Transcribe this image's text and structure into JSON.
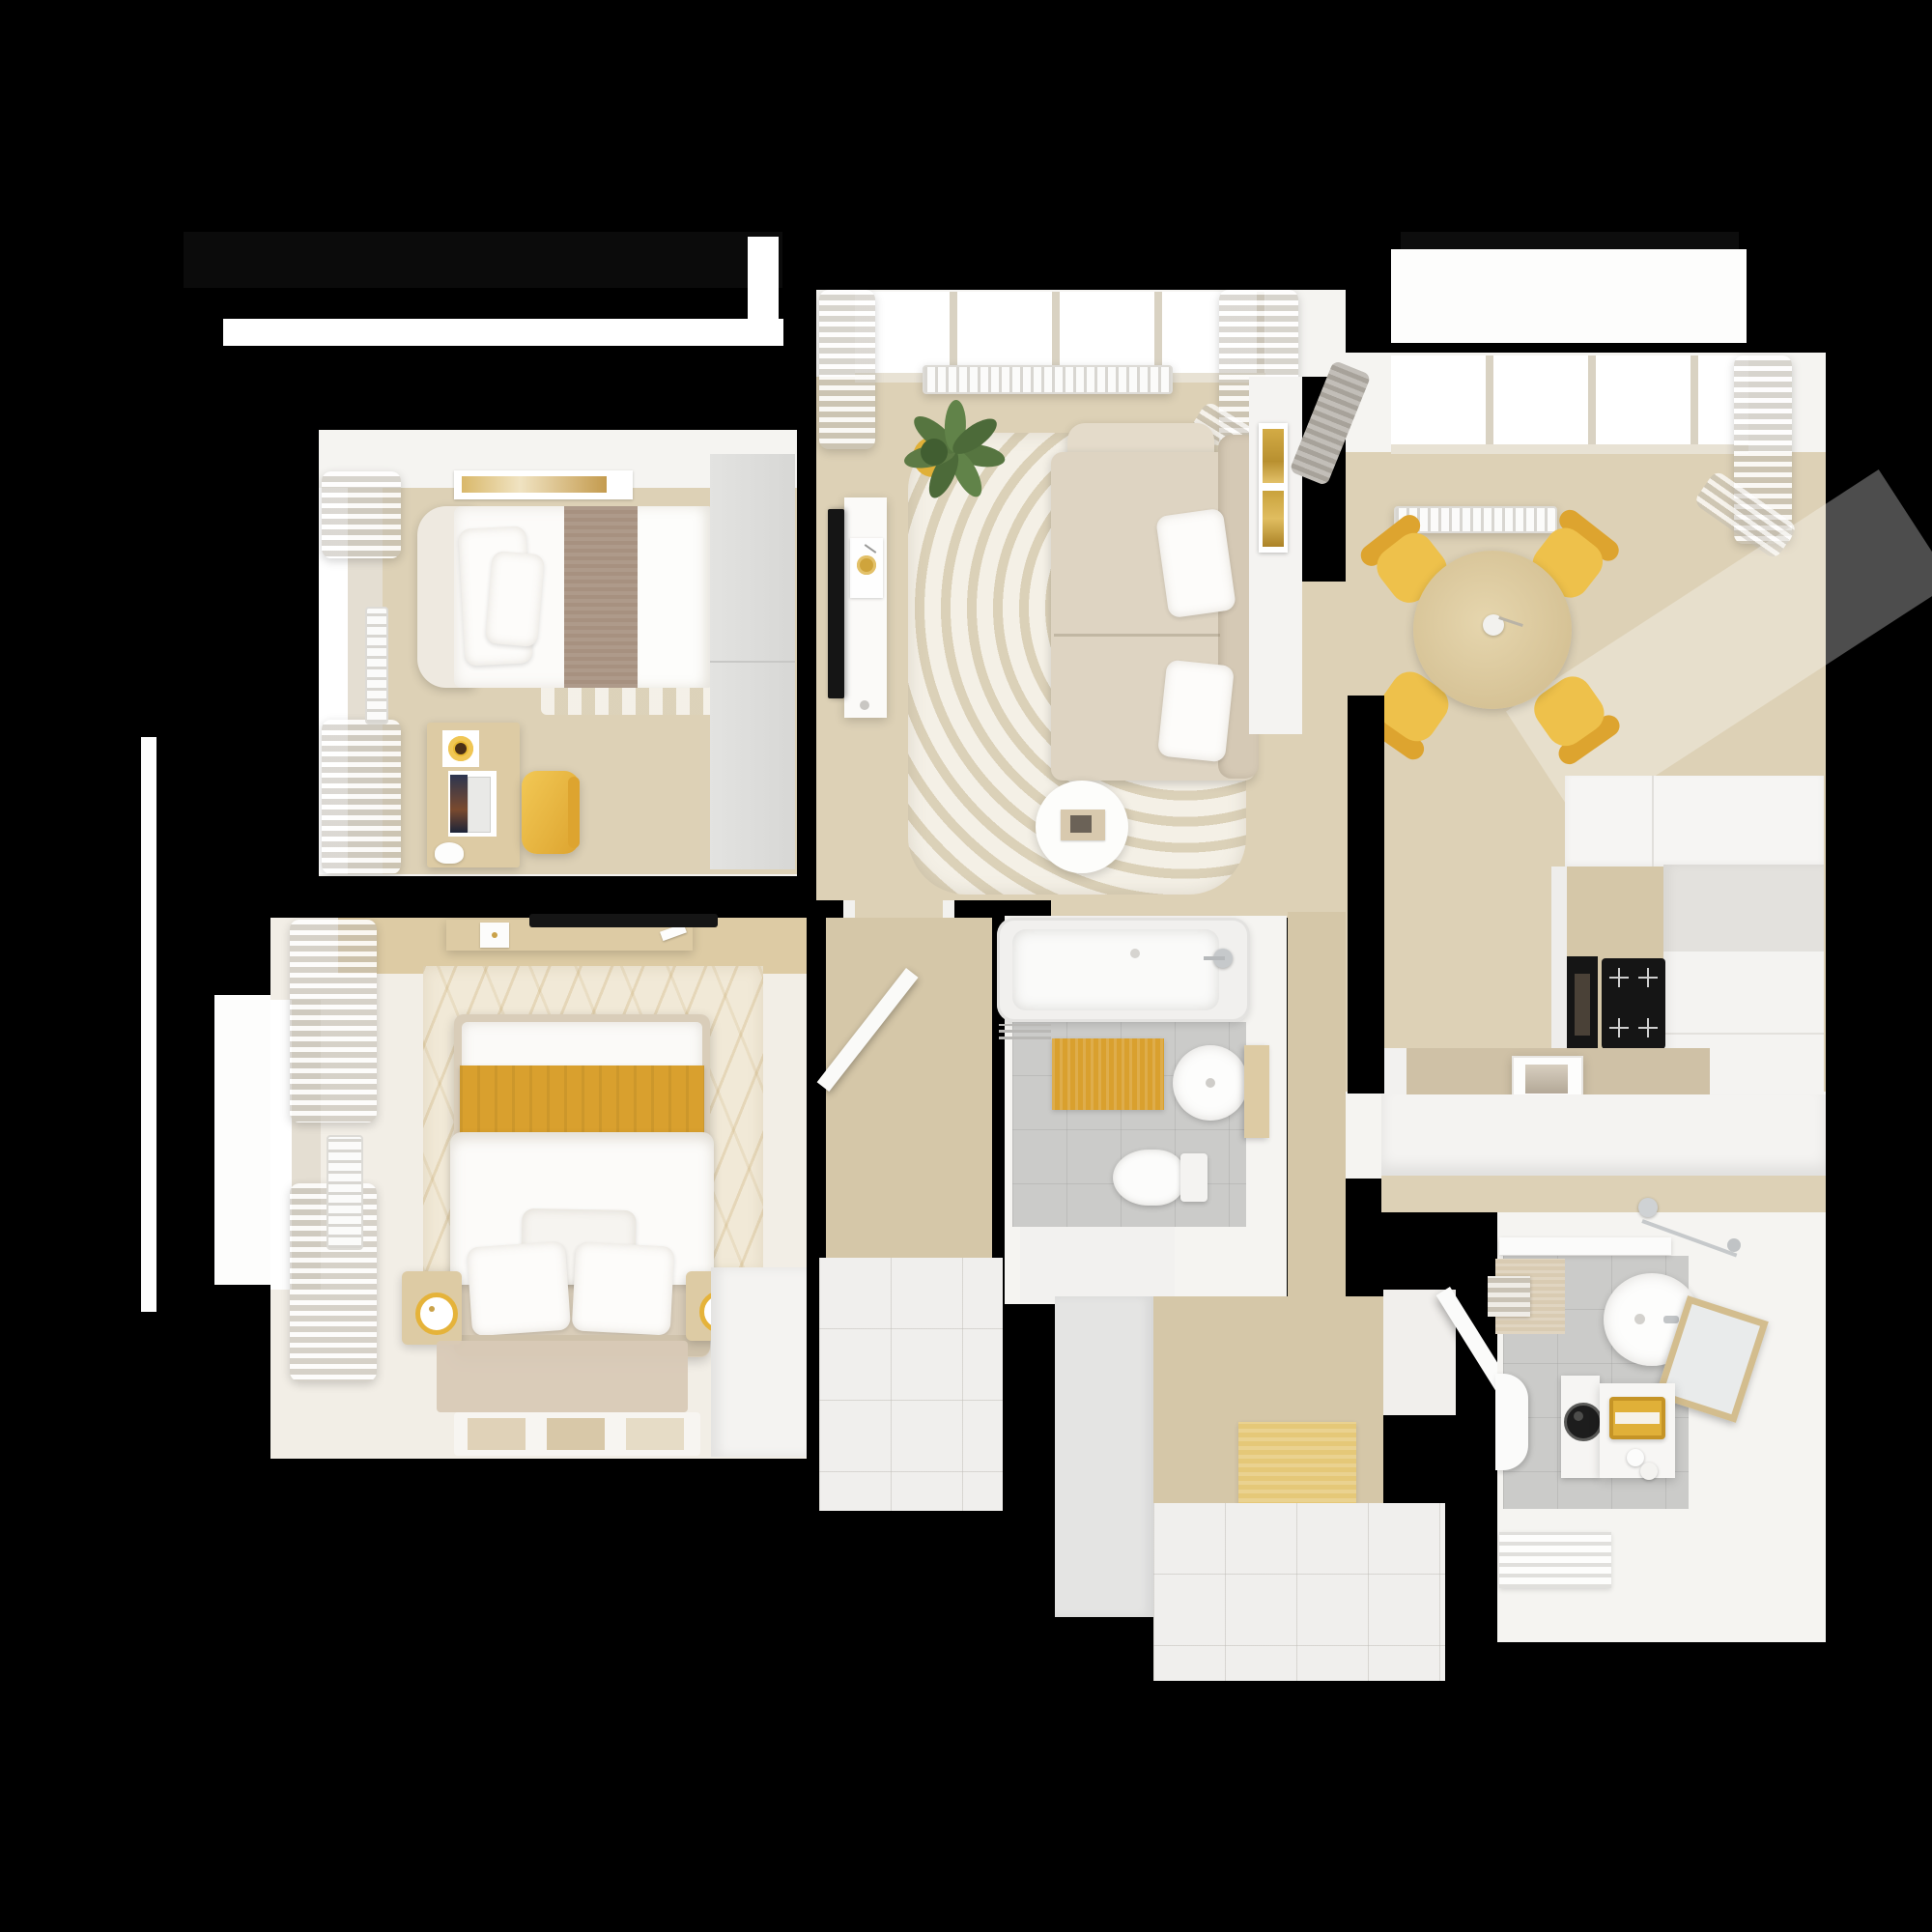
{
  "scene": {
    "type": "3d-floor-plan-top-down-render",
    "description": "Photorealistic top-down 3D floor plan of an apartment with mustard-yellow accents on a black background",
    "background_color": "#000000"
  },
  "palette": {
    "background": "#000000",
    "wall_white": "#f5f4f1",
    "floor_wood": "#ddd1b6",
    "floor_wood_deep": "#d5c7a8",
    "floor_tile_gray": "#cbcbc9",
    "floor_tile_white": "#f0efed",
    "sofa_beige": "#ded4c2",
    "sofa_beige_deep": "#d5c9b5",
    "rug_cream": "#ebe4d2",
    "mustard": "#d9a02e",
    "chair_yellow": "#eec14b",
    "chair_yellow_deep": "#dda42f",
    "door_mat_sand": "#e5c878",
    "towel_yellow": "#e0b038",
    "blanket_taupe": "#a79180",
    "table_wood": "#dccaa0",
    "furniture_wood": "#ddcba4",
    "plant_green": "#5d7a45",
    "appliance_black": "#151515",
    "curtain_gray": "#a7a29a"
  },
  "rooms": [
    {
      "id": "bedroom-2",
      "label": "Bedroom 2",
      "items": [
        "single-bed",
        "taupe-blanket-runner",
        "pillows",
        "wall-art",
        "window",
        "curtains",
        "radiator",
        "striped-rug",
        "desk",
        "laptop",
        "coffee-cup",
        "desk-lamp",
        "yellow-desk-chair",
        "gray-wardrobe"
      ]
    },
    {
      "id": "living-room",
      "label": "Living Room",
      "items": [
        "bay-window",
        "radiator",
        "curtains",
        "potted-plant",
        "wall-mounted-tv",
        "media-console",
        "record-player",
        "striped-round-rug",
        "sectional-sofa",
        "sofa-pillows",
        "round-coffee-table",
        "book",
        "gold-wall-art"
      ]
    },
    {
      "id": "dining-area",
      "label": "Dining Area",
      "items": [
        "window",
        "radiator",
        "curtains",
        "round-dining-table",
        "vase",
        "yellow-chair-nw",
        "yellow-chair-ne",
        "yellow-chair-sw",
        "yellow-chair-se"
      ]
    },
    {
      "id": "kitchen",
      "label": "Kitchen",
      "items": [
        "upper-cabinets",
        "tall-cabinet-column",
        "wood-countertop",
        "built-in-oven",
        "induction-cooktop",
        "peninsula-counter",
        "square-sink",
        "half-wall"
      ]
    },
    {
      "id": "master-bedroom",
      "label": "Master Bedroom",
      "items": [
        "double-bed",
        "mustard-throw",
        "duvet",
        "pillows",
        "headboard",
        "textured-rug",
        "nightstand-left",
        "nightstand-right",
        "ring-lamps",
        "wall-shelf-console",
        "wall-mounted-tv",
        "clock",
        "window",
        "curtains",
        "radiator",
        "foot-rug",
        "print-rug",
        "white-wardrobe",
        "open-door"
      ]
    },
    {
      "id": "bathroom",
      "label": "Bathroom",
      "items": [
        "bathtub",
        "bath-faucet",
        "mustard-bath-mat",
        "round-sink",
        "wood-shelf",
        "toilet",
        "towel-rail",
        "gray-tile-floor"
      ]
    },
    {
      "id": "hallway",
      "label": "Hallway",
      "items": [
        "wood-floor",
        "white-tile-floor",
        "doorway-jambs"
      ]
    },
    {
      "id": "entry-hall",
      "label": "Entry Hall",
      "items": [
        "storage-cabinet",
        "wood-floor",
        "sand-door-mat",
        "white-tile-floor",
        "entry-door-open"
      ]
    },
    {
      "id": "shower-room",
      "label": "Shower Room",
      "items": [
        "shower-set",
        "shower-ledge",
        "beige-mat",
        "towel-shelf",
        "round-sink",
        "wood-frame-mirror",
        "washing-machine",
        "base-cabinet",
        "yellow-towel",
        "toilet-paper-rolls",
        "toilet",
        "towel-radiator",
        "gray-tile-floor"
      ]
    }
  ]
}
